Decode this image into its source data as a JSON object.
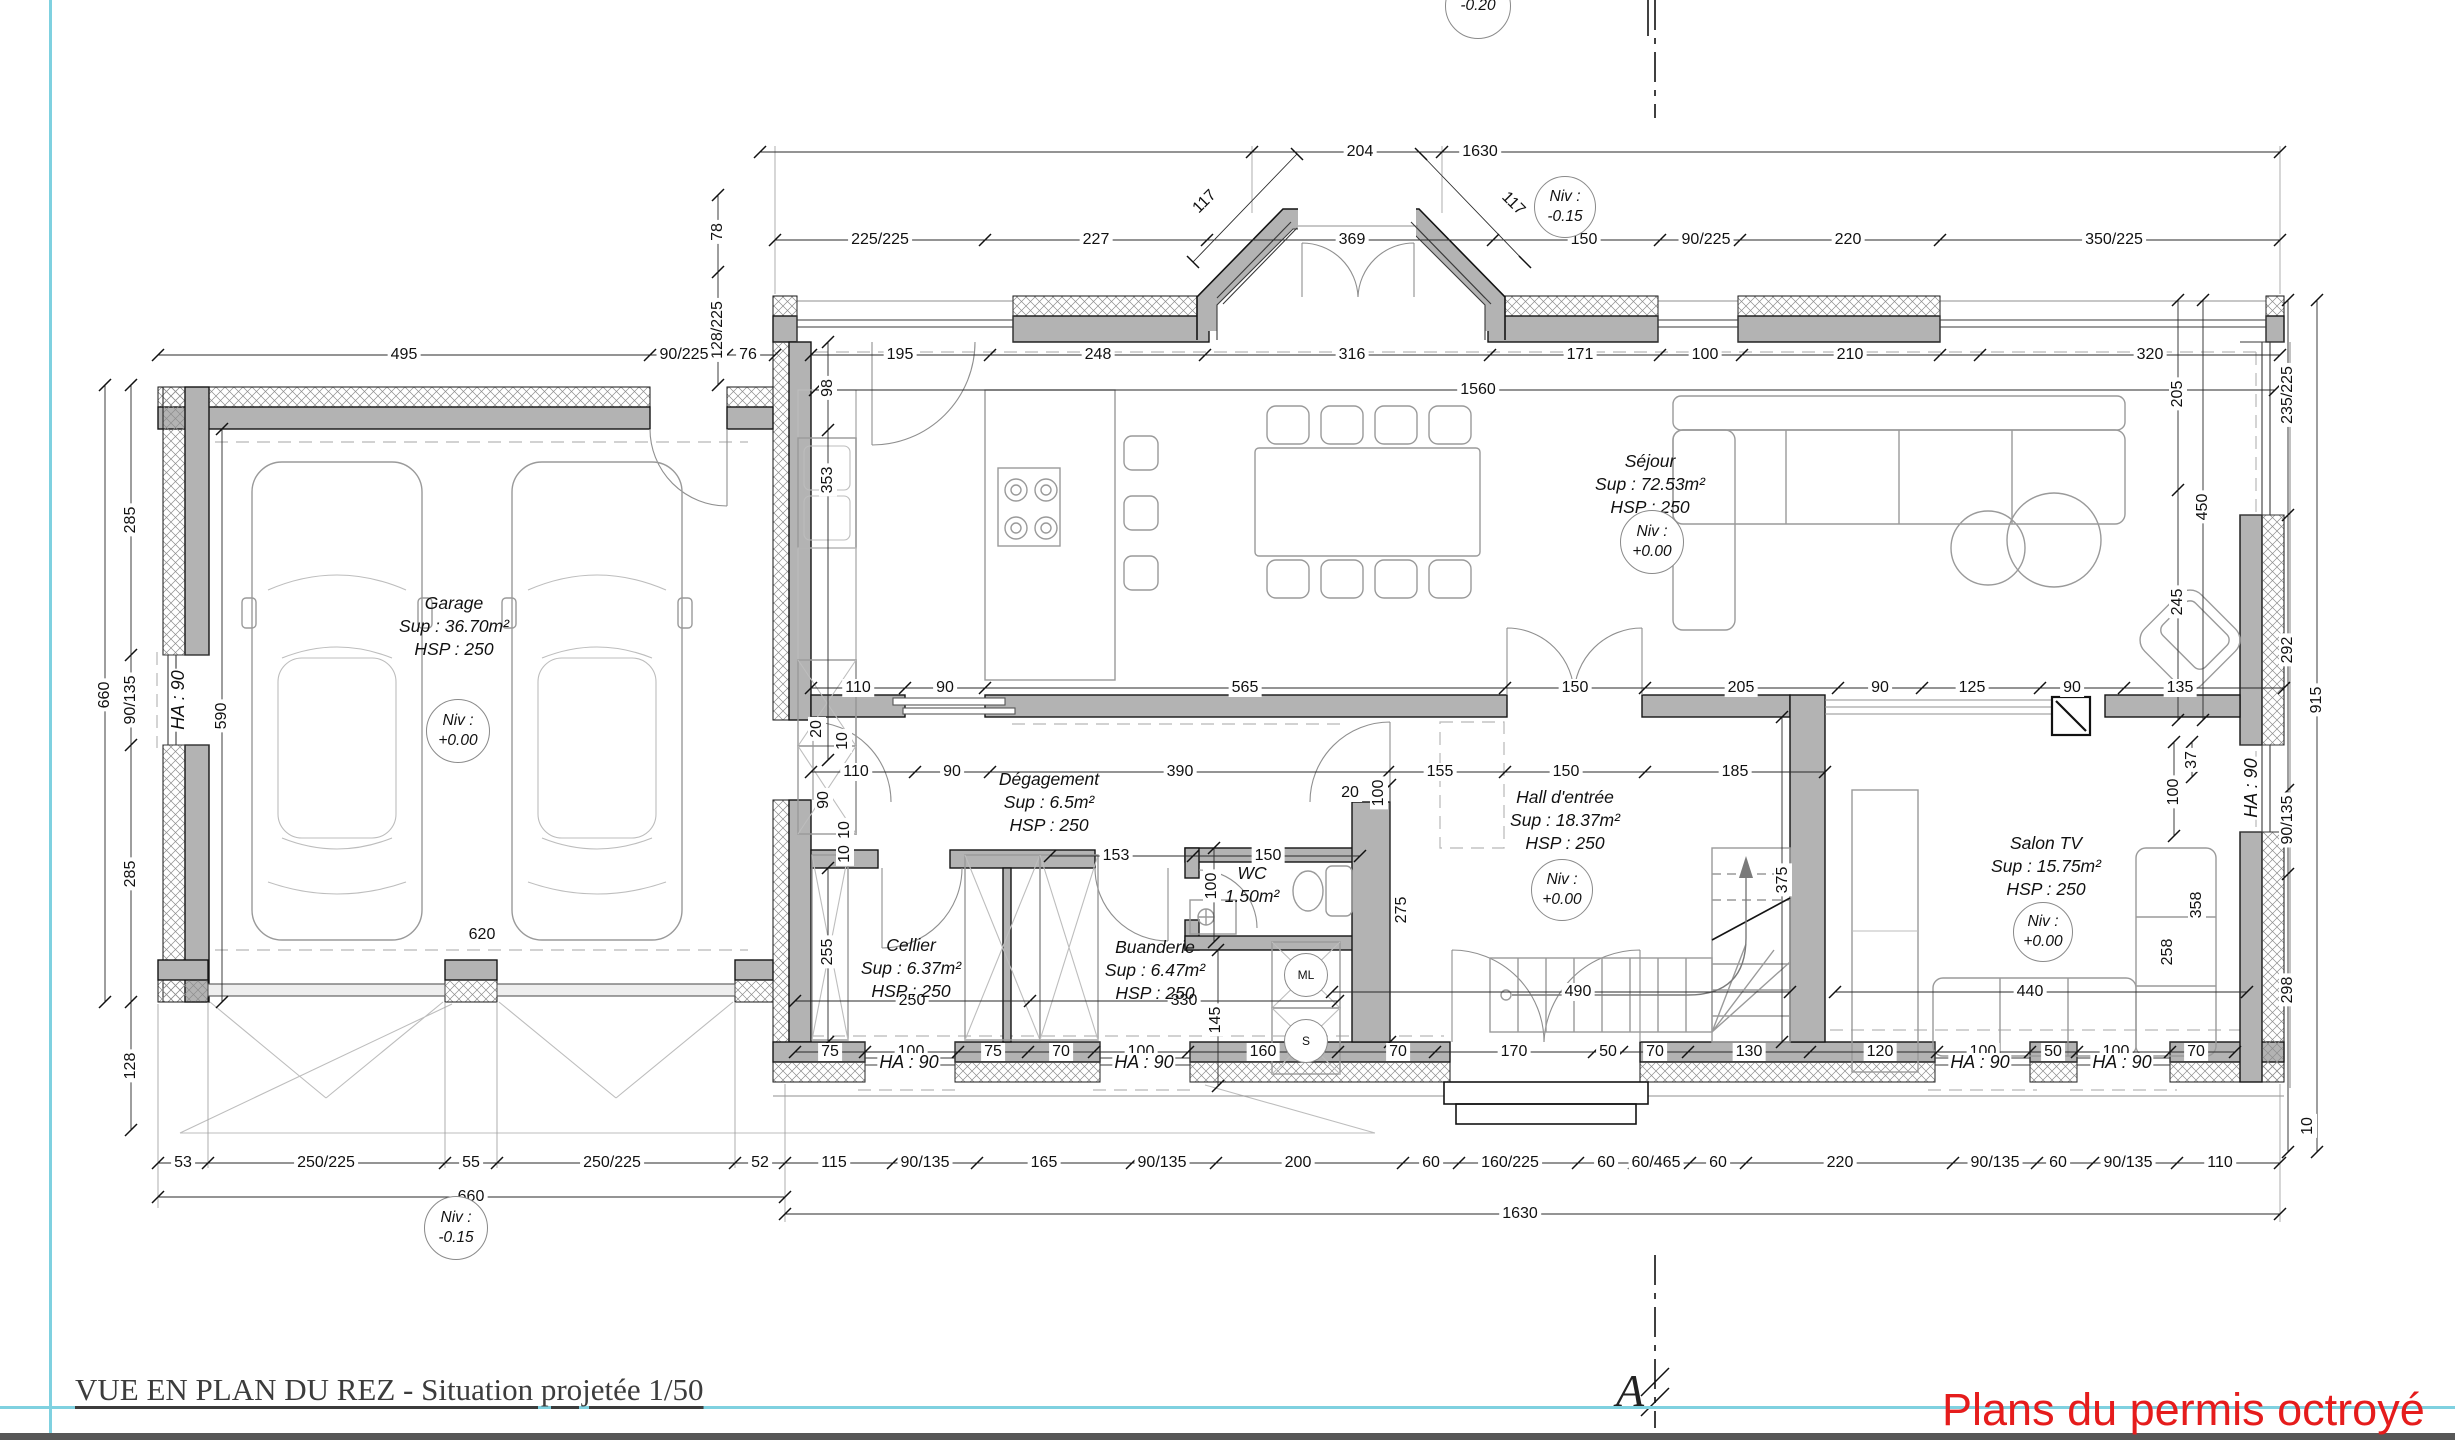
{
  "meta": {
    "title": "VUE EN PLAN DU REZ - Situation projetée 1/50",
    "stamp": "Plans du permis octroyé",
    "section_label": "A"
  },
  "rooms": [
    {
      "name": "Garage",
      "l2": "Sup : 36.70m²",
      "l3": "HSP : 250",
      "x": 454,
      "y": 592
    },
    {
      "name": "Séjour",
      "l2": "Sup : 72.53m²",
      "l3": "HSP : 250",
      "x": 1650,
      "y": 450
    },
    {
      "name": "Dégagement",
      "l2": "Sup : 6.5m²",
      "l3": "HSP : 250",
      "x": 1049,
      "y": 768
    },
    {
      "name": "Cellier",
      "l2": "Sup : 6.37m²",
      "l3": "HSP : 250",
      "x": 911,
      "y": 934
    },
    {
      "name": "Buanderie",
      "l2": "Sup : 6.47m²",
      "l3": "HSP : 250",
      "x": 1155,
      "y": 936
    },
    {
      "name": "WC",
      "l2": "1.50m²",
      "x": 1252,
      "y": 862
    },
    {
      "name": "Hall d'entrée",
      "l2": "Sup : 18.37m²",
      "l3": "HSP : 250",
      "x": 1565,
      "y": 786
    },
    {
      "name": "Salon TV",
      "l2": "Sup : 15.75m²",
      "l3": "HSP : 250",
      "x": 2046,
      "y": 832
    }
  ],
  "levels": [
    {
      "l1": "Niv :",
      "l2": "+0.00",
      "x": 458,
      "y": 731,
      "r": 31
    },
    {
      "l1": "Niv :",
      "l2": "+0.00",
      "x": 1652,
      "y": 542,
      "r": 31
    },
    {
      "l1": "Niv :",
      "l2": "+0.00",
      "x": 1562,
      "y": 890,
      "r": 30
    },
    {
      "l1": "Niv :",
      "l2": "+0.00",
      "x": 2043,
      "y": 932,
      "r": 29
    },
    {
      "l1": "Niv :",
      "l2": "-0.15",
      "x": 1565,
      "y": 207,
      "r": 30
    },
    {
      "l1": "Niv :",
      "l2": "-0.15",
      "x": 456,
      "y": 1228,
      "r": 31
    },
    {
      "l2": "-0.20",
      "x": 1478,
      "y": 6,
      "r": 32
    }
  ],
  "appliances": [
    {
      "t": "ML",
      "x": 1306,
      "y": 975,
      "r": 21
    },
    {
      "t": "S",
      "x": 1306,
      "y": 1041,
      "r": 21
    }
  ],
  "ha_labels": [
    {
      "t": "HA : 90",
      "x": 178,
      "y": 700,
      "r": -90
    },
    {
      "t": "HA : 90",
      "x": 909,
      "y": 1062
    },
    {
      "t": "HA : 90",
      "x": 1144,
      "y": 1062
    },
    {
      "t": "HA : 90",
      "x": 1980,
      "y": 1062
    },
    {
      "t": "HA : 90",
      "x": 2122,
      "y": 1062
    },
    {
      "t": "HA : 90",
      "x": 2251,
      "y": 788,
      "r": -90
    }
  ],
  "dims": [
    {
      "t": "204",
      "x": 1360,
      "y": 152
    },
    {
      "t": "1630",
      "x": 1480,
      "y": 152
    },
    {
      "t": "117",
      "x": 1205,
      "y": 202,
      "r": -45
    },
    {
      "t": "117",
      "x": 1513,
      "y": 204,
      "r": 45
    },
    {
      "t": "225/225",
      "x": 880,
      "y": 240
    },
    {
      "t": "227",
      "x": 1096,
      "y": 240
    },
    {
      "t": "369",
      "x": 1352,
      "y": 240
    },
    {
      "t": "150",
      "x": 1584,
      "y": 240
    },
    {
      "t": "90/225",
      "x": 1706,
      "y": 240
    },
    {
      "t": "220",
      "x": 1848,
      "y": 240
    },
    {
      "t": "350/225",
      "x": 2114,
      "y": 240
    },
    {
      "t": "78",
      "x": 718,
      "y": 232,
      "r": -90
    },
    {
      "t": "128/225",
      "x": 718,
      "y": 330,
      "r": -90
    },
    {
      "t": "495",
      "x": 404,
      "y": 355
    },
    {
      "t": "90/225",
      "x": 684,
      "y": 355
    },
    {
      "t": "76",
      "x": 748,
      "y": 355
    },
    {
      "t": "195",
      "x": 900,
      "y": 355
    },
    {
      "t": "248",
      "x": 1098,
      "y": 355
    },
    {
      "t": "316",
      "x": 1352,
      "y": 355
    },
    {
      "t": "171",
      "x": 1580,
      "y": 355
    },
    {
      "t": "100",
      "x": 1705,
      "y": 355
    },
    {
      "t": "210",
      "x": 1850,
      "y": 355
    },
    {
      "t": "320",
      "x": 2150,
      "y": 355
    },
    {
      "t": "1560",
      "x": 1478,
      "y": 390
    },
    {
      "t": "98",
      "x": 828,
      "y": 388,
      "r": -90
    },
    {
      "t": "353",
      "x": 828,
      "y": 480,
      "r": -90
    },
    {
      "t": "285",
      "x": 131,
      "y": 520,
      "r": -90
    },
    {
      "t": "90/135",
      "x": 131,
      "y": 700,
      "r": -90
    },
    {
      "t": "660",
      "x": 105,
      "y": 695,
      "r": -90
    },
    {
      "t": "590",
      "x": 222,
      "y": 716,
      "r": -90
    },
    {
      "t": "285",
      "x": 131,
      "y": 874,
      "r": -90
    },
    {
      "t": "128",
      "x": 131,
      "y": 1066,
      "r": -90
    },
    {
      "t": "620",
      "x": 482,
      "y": 935
    },
    {
      "t": "110",
      "x": 858,
      "y": 688
    },
    {
      "t": "90",
      "x": 945,
      "y": 688
    },
    {
      "t": "565",
      "x": 1245,
      "y": 688
    },
    {
      "t": "150",
      "x": 1575,
      "y": 688
    },
    {
      "t": "205",
      "x": 1741,
      "y": 688
    },
    {
      "t": "90",
      "x": 1880,
      "y": 688
    },
    {
      "t": "125",
      "x": 1972,
      "y": 688
    },
    {
      "t": "90",
      "x": 2072,
      "y": 688
    },
    {
      "t": "135",
      "x": 2180,
      "y": 688
    },
    {
      "t": "110",
      "x": 856,
      "y": 772
    },
    {
      "t": "90",
      "x": 952,
      "y": 772
    },
    {
      "t": "390",
      "x": 1180,
      "y": 772
    },
    {
      "t": "155",
      "x": 1440,
      "y": 772
    },
    {
      "t": "150",
      "x": 1566,
      "y": 772
    },
    {
      "t": "185",
      "x": 1735,
      "y": 772
    },
    {
      "t": "20",
      "x": 817,
      "y": 729,
      "r": -90
    },
    {
      "t": "10",
      "x": 843,
      "y": 741,
      "r": -90
    },
    {
      "t": "90",
      "x": 824,
      "y": 800,
      "r": -90
    },
    {
      "t": "10",
      "x": 845,
      "y": 830,
      "r": -90
    },
    {
      "t": "10",
      "x": 845,
      "y": 854,
      "r": -90
    },
    {
      "t": "20",
      "x": 1350,
      "y": 793
    },
    {
      "t": "100",
      "x": 1379,
      "y": 793,
      "r": -90
    },
    {
      "t": "153",
      "x": 1116,
      "y": 856
    },
    {
      "t": "150",
      "x": 1268,
      "y": 856
    },
    {
      "t": "100",
      "x": 1212,
      "y": 886,
      "r": -90
    },
    {
      "t": "255",
      "x": 828,
      "y": 952,
      "r": -90
    },
    {
      "t": "275",
      "x": 1402,
      "y": 910,
      "r": -90
    },
    {
      "t": "250",
      "x": 912,
      "y": 1001
    },
    {
      "t": "330",
      "x": 1184,
      "y": 1001
    },
    {
      "t": "145",
      "x": 1216,
      "y": 1020,
      "r": -90
    },
    {
      "t": "375",
      "x": 1783,
      "y": 880,
      "r": -90
    },
    {
      "t": "490",
      "x": 1578,
      "y": 992
    },
    {
      "t": "440",
      "x": 2030,
      "y": 992
    },
    {
      "t": "358",
      "x": 2197,
      "y": 905,
      "r": -90
    },
    {
      "t": "258",
      "x": 2168,
      "y": 952,
      "r": -90
    },
    {
      "t": "75",
      "x": 830,
      "y": 1052
    },
    {
      "t": "100",
      "x": 911,
      "y": 1052
    },
    {
      "t": "75",
      "x": 993,
      "y": 1052
    },
    {
      "t": "70",
      "x": 1061,
      "y": 1052
    },
    {
      "t": "100",
      "x": 1141,
      "y": 1052
    },
    {
      "t": "160",
      "x": 1263,
      "y": 1052
    },
    {
      "t": "70",
      "x": 1398,
      "y": 1052
    },
    {
      "t": "170",
      "x": 1514,
      "y": 1052
    },
    {
      "t": "50",
      "x": 1608,
      "y": 1052
    },
    {
      "t": "70",
      "x": 1655,
      "y": 1052
    },
    {
      "t": "130",
      "x": 1749,
      "y": 1052
    },
    {
      "t": "120",
      "x": 1880,
      "y": 1052
    },
    {
      "t": "100",
      "x": 1983,
      "y": 1052
    },
    {
      "t": "50",
      "x": 2053,
      "y": 1052
    },
    {
      "t": "100",
      "x": 2116,
      "y": 1052
    },
    {
      "t": "70",
      "x": 2196,
      "y": 1052
    },
    {
      "t": "53",
      "x": 183,
      "y": 1163
    },
    {
      "t": "250/225",
      "x": 326,
      "y": 1163
    },
    {
      "t": "55",
      "x": 471,
      "y": 1163
    },
    {
      "t": "250/225",
      "x": 612,
      "y": 1163
    },
    {
      "t": "52",
      "x": 760,
      "y": 1163
    },
    {
      "t": "115",
      "x": 834,
      "y": 1163
    },
    {
      "t": "90/135",
      "x": 925,
      "y": 1163
    },
    {
      "t": "165",
      "x": 1044,
      "y": 1163
    },
    {
      "t": "90/135",
      "x": 1162,
      "y": 1163
    },
    {
      "t": "200",
      "x": 1298,
      "y": 1163
    },
    {
      "t": "60",
      "x": 1431,
      "y": 1163
    },
    {
      "t": "160/225",
      "x": 1510,
      "y": 1163
    },
    {
      "t": "60",
      "x": 1606,
      "y": 1163
    },
    {
      "t": "60/465",
      "x": 1656,
      "y": 1163
    },
    {
      "t": "60",
      "x": 1718,
      "y": 1163
    },
    {
      "t": "220",
      "x": 1840,
      "y": 1163
    },
    {
      "t": "90/135",
      "x": 1995,
      "y": 1163
    },
    {
      "t": "60",
      "x": 2058,
      "y": 1163
    },
    {
      "t": "90/135",
      "x": 2128,
      "y": 1163
    },
    {
      "t": "110",
      "x": 2220,
      "y": 1163
    },
    {
      "t": "660",
      "x": 471,
      "y": 1197
    },
    {
      "t": "1630",
      "x": 1520,
      "y": 1214
    },
    {
      "t": "235/225",
      "x": 2288,
      "y": 395,
      "r": -90
    },
    {
      "t": "205",
      "x": 2178,
      "y": 394,
      "r": -90
    },
    {
      "t": "450",
      "x": 2203,
      "y": 507,
      "r": -90
    },
    {
      "t": "245",
      "x": 2178,
      "y": 602,
      "r": -90
    },
    {
      "t": "292",
      "x": 2288,
      "y": 650,
      "r": -90
    },
    {
      "t": "915",
      "x": 2317,
      "y": 700,
      "r": -90
    },
    {
      "t": "37",
      "x": 2192,
      "y": 760,
      "r": -90
    },
    {
      "t": "100",
      "x": 2174,
      "y": 792,
      "r": -90
    },
    {
      "t": "90/135",
      "x": 2288,
      "y": 820,
      "r": -90
    },
    {
      "t": "298",
      "x": 2288,
      "y": 990,
      "r": -90
    },
    {
      "t": "10",
      "x": 2308,
      "y": 1126,
      "r": -90
    }
  ]
}
